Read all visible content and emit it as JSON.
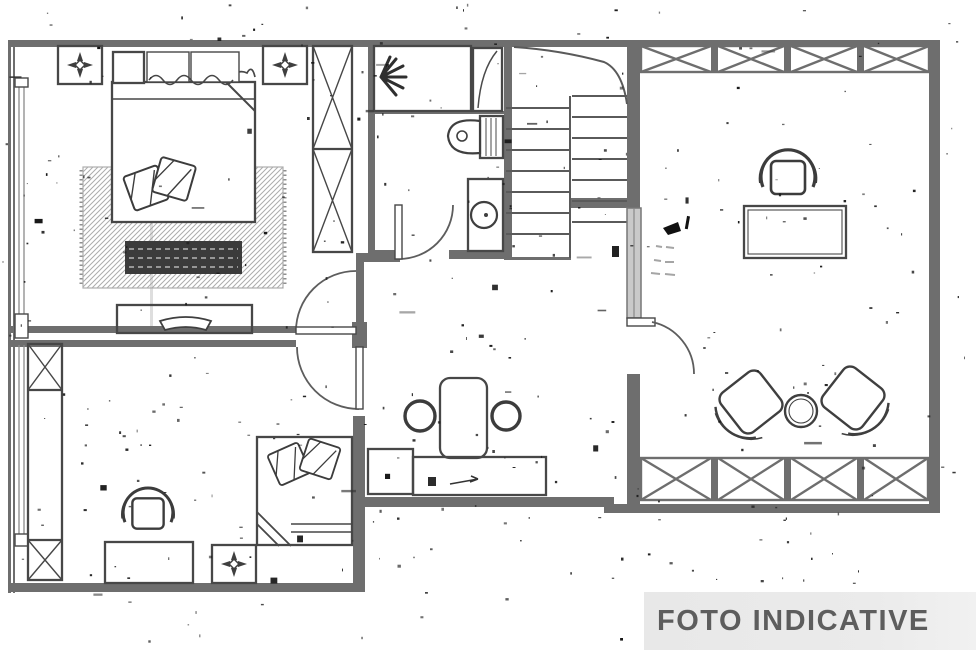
{
  "banner": {
    "label": "FOTO INDICATIVE",
    "bg": "#e8e8e8",
    "text_color": "#5d5d5d"
  },
  "palette": {
    "paper": "#ffffff",
    "wall": "#6e6e6e",
    "fixture": "#474747",
    "sliding_door_fill": "#c9c9c9",
    "rug_hatch": "#9d9d9d",
    "bench_fill": "#3b3b3b",
    "noise": "#141414"
  },
  "noise": {
    "seed": 11,
    "specks": 300,
    "blobs": 12,
    "dashes": 14
  },
  "drawing": {
    "type": "scanned-floor-plan",
    "fixtures": [
      {
        "name": "ceiling-vent-icon",
        "count": 3
      },
      {
        "name": "double-bed",
        "count": 1
      },
      {
        "name": "single-bed",
        "count": 1
      },
      {
        "name": "rug",
        "count": 1
      },
      {
        "name": "storage-bench",
        "count": 1
      },
      {
        "name": "nightstand",
        "count": 1
      },
      {
        "name": "headboard-cushion",
        "count": 2
      },
      {
        "name": "tv-dresser",
        "count": 1
      },
      {
        "name": "crossed-wardrobe-cell",
        "count": 4
      },
      {
        "name": "shower",
        "count": 1
      },
      {
        "name": "toilet",
        "count": 1
      },
      {
        "name": "washbasin",
        "count": 1
      },
      {
        "name": "staircase-steps",
        "count": 13
      },
      {
        "name": "dining-table",
        "count": 1
      },
      {
        "name": "stool",
        "count": 2
      },
      {
        "name": "kitchen-counter",
        "count": 2
      },
      {
        "name": "desk",
        "count": 2
      },
      {
        "name": "office-chair",
        "count": 2
      },
      {
        "name": "armchair",
        "count": 2
      },
      {
        "name": "coffee-table",
        "count": 1
      },
      {
        "name": "balcony-railing-x",
        "count": 2
      },
      {
        "name": "sliding-door",
        "count": 1
      },
      {
        "name": "hinged-door",
        "count": 4
      },
      {
        "name": "window",
        "count": 2
      }
    ]
  }
}
